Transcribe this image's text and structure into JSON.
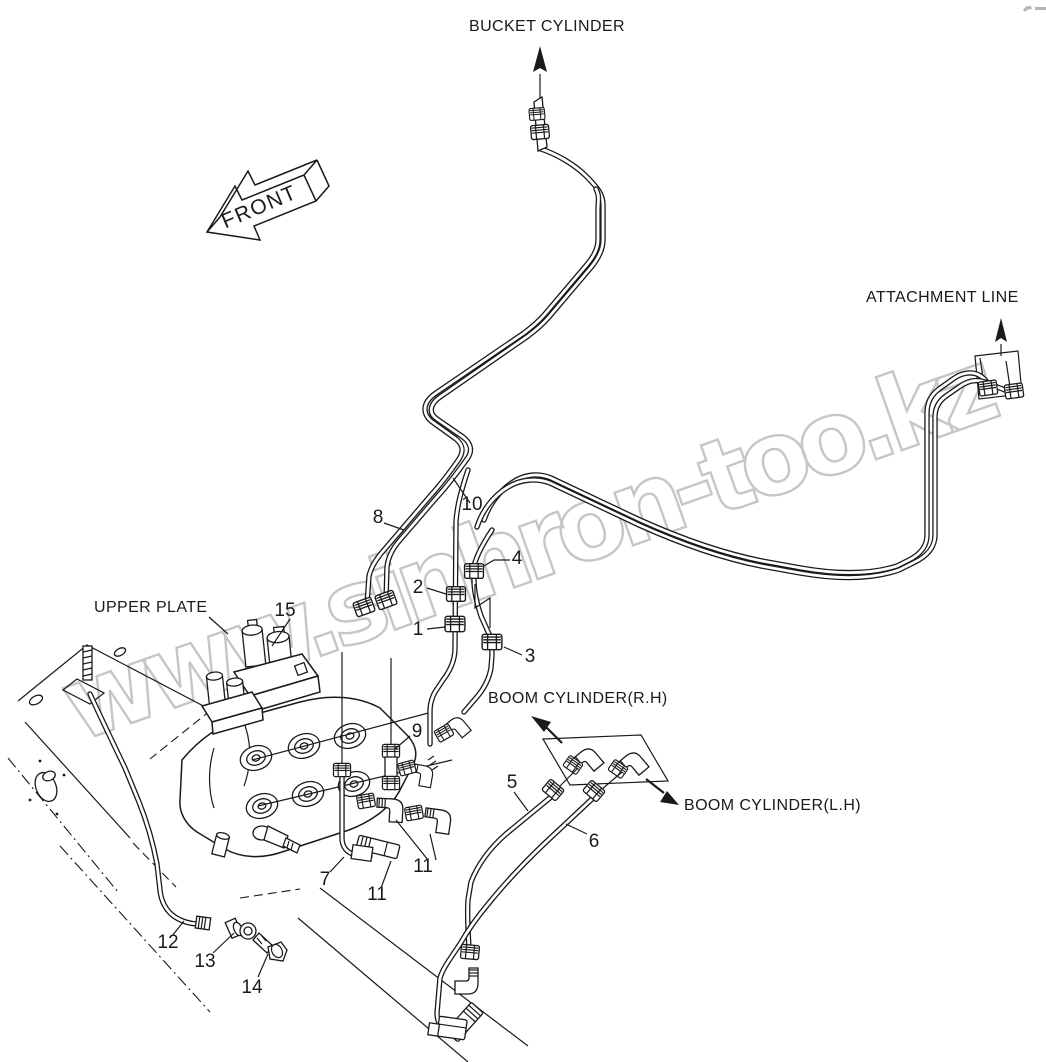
{
  "page": {
    "background": "#ffffff",
    "line_color": "#1a1a1a"
  },
  "watermark": {
    "text": "www.sinhron-too.kz",
    "color": "#c6c6c6"
  },
  "direction_arrow": {
    "label": "FRONT"
  },
  "labels": {
    "bucket_cylinder": "BUCKET CYLINDER",
    "attachment_line": "ATTACHMENT LINE",
    "upper_plate": "UPPER PLATE",
    "boom_cylinder_rh": "BOOM CYLINDER(R.H)",
    "boom_cylinder_lh": "BOOM CYLINDER(L.H)"
  },
  "callouts": [
    {
      "label": "1"
    },
    {
      "label": "2"
    },
    {
      "label": "3"
    },
    {
      "label": "4"
    },
    {
      "label": "5"
    },
    {
      "label": "6"
    },
    {
      "label": "7"
    },
    {
      "label": "8"
    },
    {
      "label": "9"
    },
    {
      "label": "10"
    },
    {
      "label": "11"
    },
    {
      "label": "11"
    },
    {
      "label": "12"
    },
    {
      "label": "13"
    },
    {
      "label": "14"
    },
    {
      "label": "15"
    }
  ]
}
